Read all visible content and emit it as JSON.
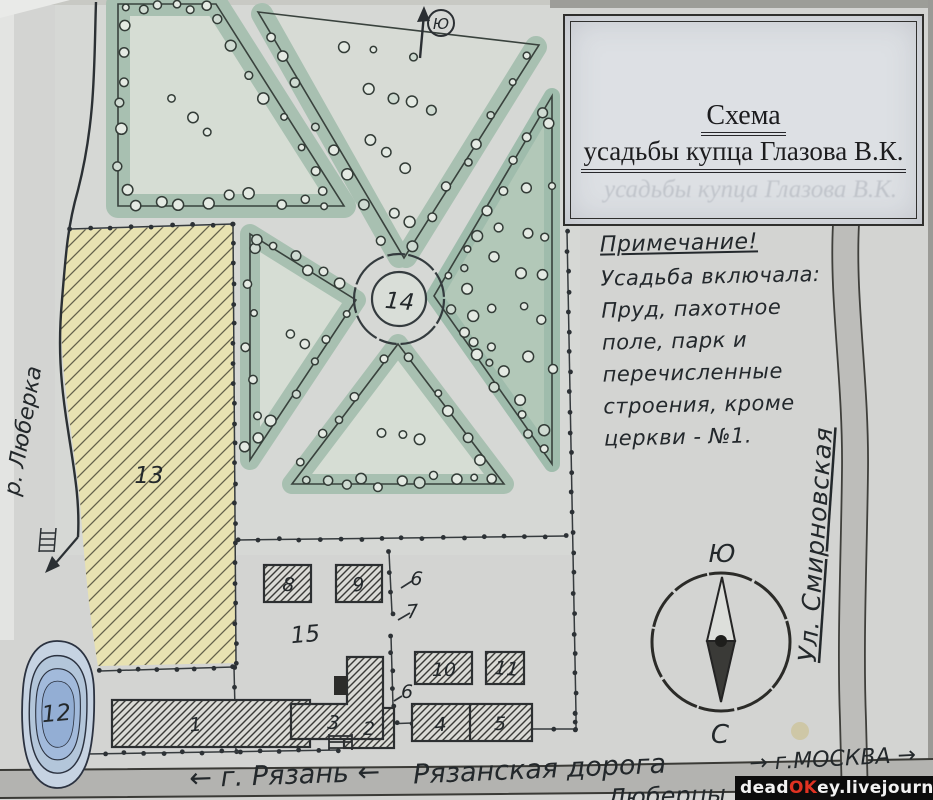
{
  "title_box": {
    "line1": "Схема",
    "line2": "усадьбы купца Глазова В.К.",
    "ghost": "усадьбы купца Глазова В.К."
  },
  "note": {
    "heading": "Примечание!",
    "lines": [
      "Усадьба включала:",
      "Пруд, пахотное",
      "поле, парк и",
      "перечисленные",
      "строения, кроме",
      "церкви - №1."
    ]
  },
  "compass": {
    "south": "Ю",
    "north": "С"
  },
  "north_arrow": {
    "label": "Ю"
  },
  "waterway": {
    "river": "р. Люберка"
  },
  "streets": {
    "street_right": "Ул. Смирновская",
    "road_name": "Рязанская дорога",
    "road_west": "← г. Рязань ←",
    "road_east": "→ г.МОСКВА →",
    "settlement": "Люберцы"
  },
  "map_numbers": [
    {
      "n": "1",
      "x": 196,
      "y": 731
    },
    {
      "n": "2",
      "x": 369,
      "y": 735
    },
    {
      "n": "3",
      "x": 333,
      "y": 729
    },
    {
      "n": "4",
      "x": 441,
      "y": 731
    },
    {
      "n": "5",
      "x": 500,
      "y": 730
    },
    {
      "n": "6",
      "x": 416,
      "y": 585
    },
    {
      "n": "7",
      "x": 413,
      "y": 618
    },
    {
      "n": "6",
      "x": 407,
      "y": 698
    },
    {
      "n": "8",
      "x": 288,
      "y": 591
    },
    {
      "n": "9",
      "x": 359,
      "y": 591
    },
    {
      "n": "10",
      "x": 444,
      "y": 676
    },
    {
      "n": "11",
      "x": 506,
      "y": 675
    },
    {
      "n": "12",
      "x": 57,
      "y": 721
    },
    {
      "n": "13",
      "x": 149,
      "y": 483
    },
    {
      "n": "14",
      "x": 399,
      "y": 309
    },
    {
      "n": "15",
      "x": 306,
      "y": 642
    }
  ],
  "watermark": {
    "parts": [
      {
        "text": "dead",
        "style": "white"
      },
      {
        "text": "OK",
        "style": "red"
      },
      {
        "text": "ey",
        "style": "white"
      },
      {
        "text": ".livejournal",
        "style": "white"
      },
      {
        "text": ".com",
        "style": "redbox"
      }
    ]
  }
}
